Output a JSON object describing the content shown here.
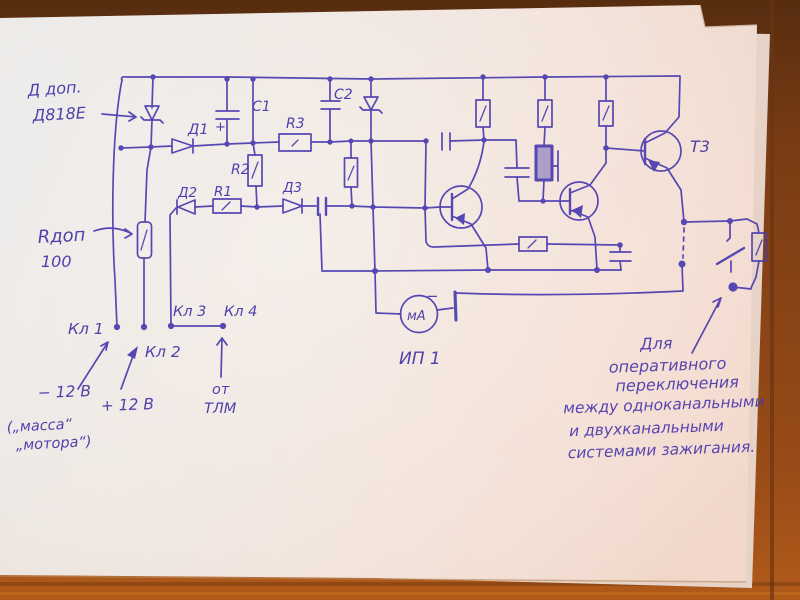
{
  "photo": {
    "ink_color": "#4b3cb0",
    "paper_color": "#f1e7e1",
    "wood_top_color": "#5f3211",
    "wood_bottom_color": "#aa581b"
  },
  "labels": {
    "d_dop_line1": "Д доп.",
    "d_dop_line2": "Д818Е",
    "d1": "Д1",
    "c1": "C1",
    "c1_plus": "+",
    "r2": "R2",
    "r3": "R3",
    "c2": "C2",
    "d2": "Д2",
    "r1": "R1",
    "d3": "Д3",
    "r_dop": "Rдоп",
    "r_dop_value": "100",
    "kl1": "Кл 1",
    "kl2": "Кл 2",
    "kl3": "Кл 3",
    "kl4": "Кл 4",
    "minus_12v": "− 12 В",
    "plus_12v": "+ 12 В",
    "massa_line1": "(„масса“",
    "massa_line2": "„мотора“)",
    "ot": "от",
    "tlm": "ТЛМ",
    "meter": "мА",
    "meter_minus": "−",
    "ip1": "ИП 1",
    "t3": "Т3",
    "note_line1": "Для",
    "note_line2": "оперативного",
    "note_line3": "переключения",
    "note_line4": "между одноканальными",
    "note_line5": "и двухканальными",
    "note_line6": "системами зажигания."
  }
}
